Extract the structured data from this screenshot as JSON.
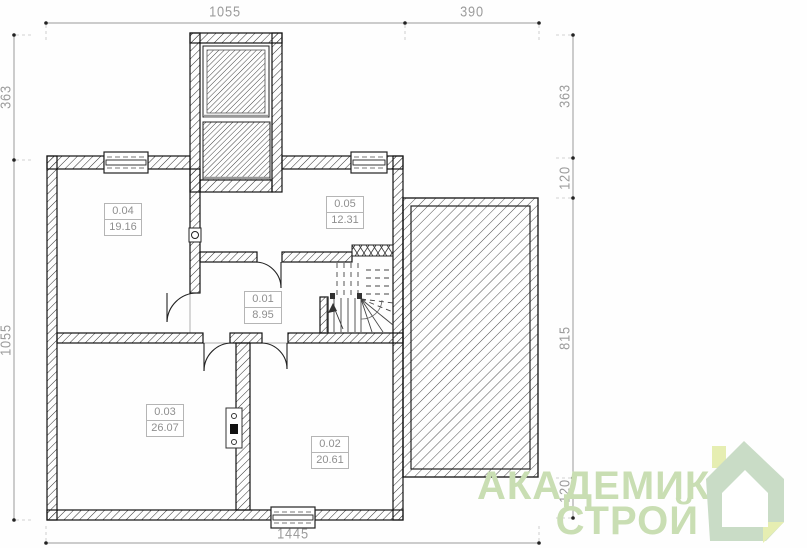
{
  "rooms": [
    {
      "number": "0.04",
      "area": "19.16"
    },
    {
      "number": "0.05",
      "area": "12.31"
    },
    {
      "number": "0.01",
      "area": "8.95"
    },
    {
      "number": "0.03",
      "area": "26.07"
    },
    {
      "number": "0.02",
      "area": "20.61"
    }
  ],
  "dimensions": {
    "top_main": "1055",
    "top_terrace": "390",
    "left_upper": "363",
    "left_main": "1055",
    "right_upper": "363",
    "right_offset_top": "120",
    "right_terrace": "815",
    "right_offset_bottom": "120",
    "bottom_total": "1445"
  },
  "logo": {
    "line1": "АКАДЕМИК",
    "line2": "СТРОЙ",
    "text_color": "#c9deb3",
    "house_body_color": "#c9dcc6",
    "house_accent_color": "#e6eeb2"
  },
  "colors": {
    "wall_line": "#1a1a1a",
    "dimension_text": "#9c9c9c",
    "room_label_text": "#8f8f8f"
  }
}
